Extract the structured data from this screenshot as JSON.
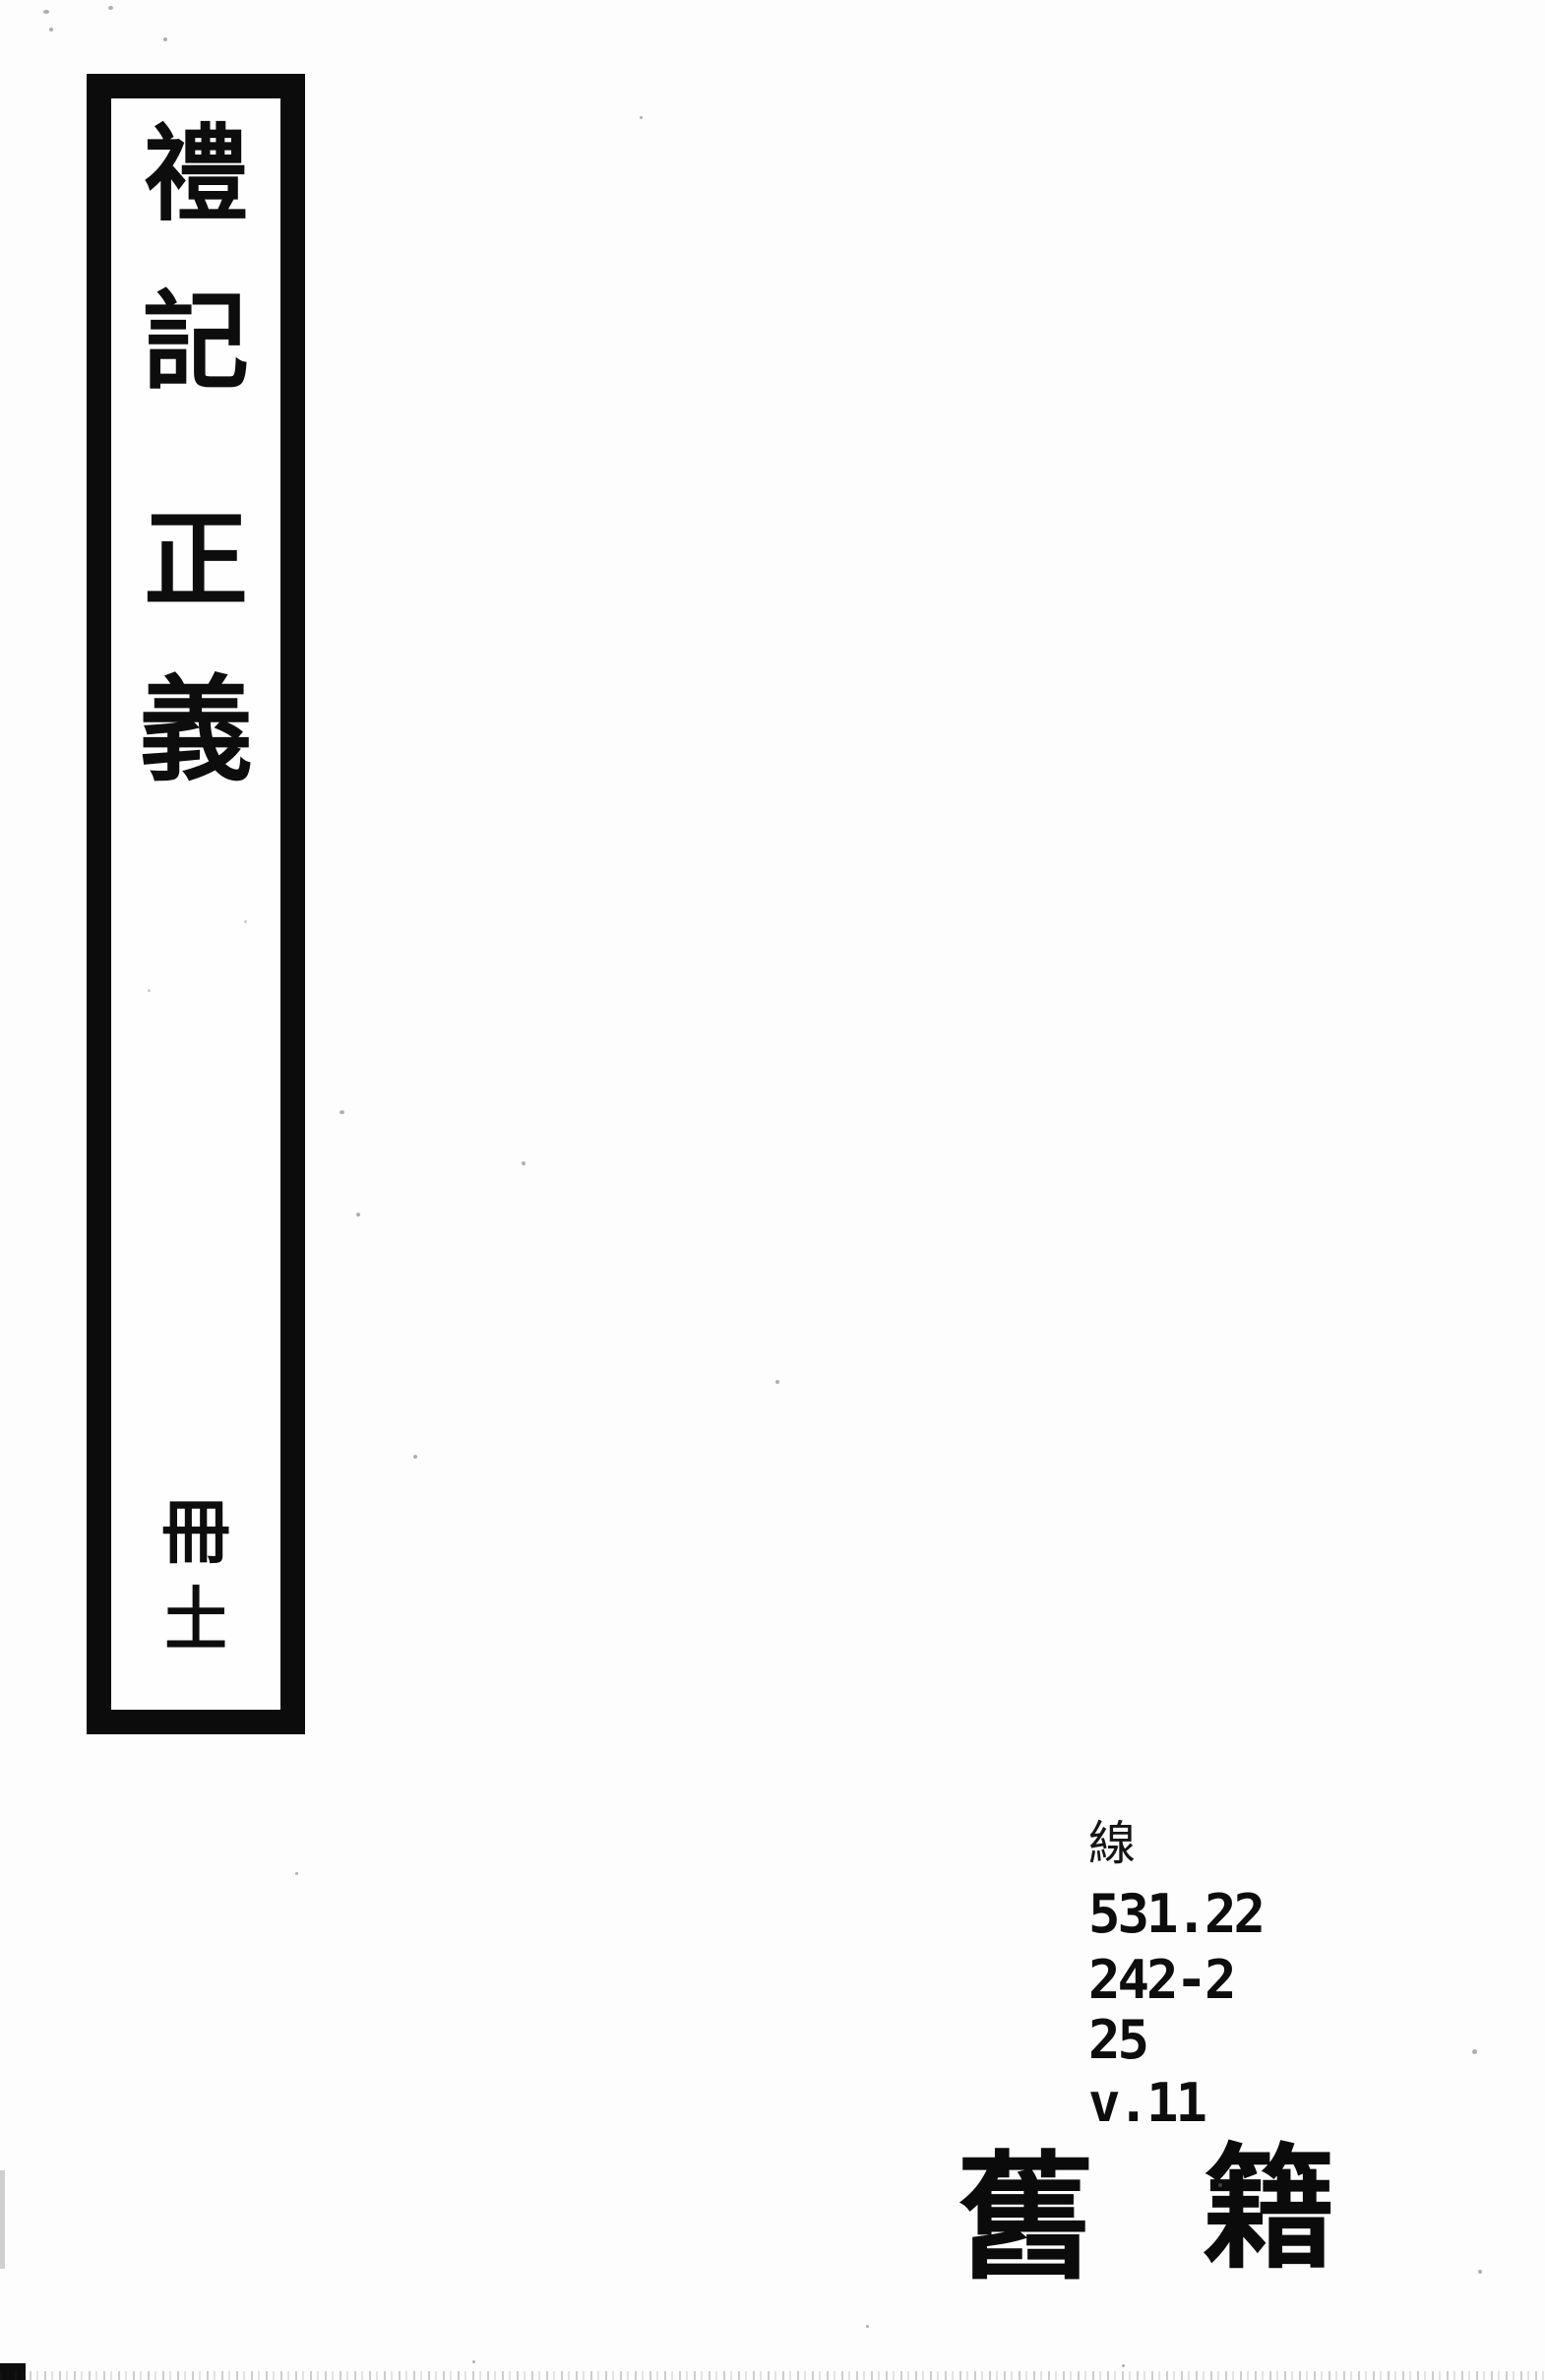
{
  "page": {
    "kind": "scanned book spine label",
    "paper_color": "#fdfdfd",
    "ink_color": "#0d0d0d"
  },
  "spine_label": {
    "title_text": "禮記正義",
    "title_chars": [
      "禮",
      "記",
      "正",
      "義"
    ],
    "volume_text": "冊十一",
    "volume_chars": [
      "冊",
      "十",
      "一"
    ]
  },
  "call_number": {
    "material_label": "線",
    "line1": "531.22",
    "line2": "242-2",
    "line3": "25",
    "line4": "v.11"
  },
  "stamp": {
    "text": "舊籍",
    "char1": "舊",
    "char2": "籍"
  }
}
